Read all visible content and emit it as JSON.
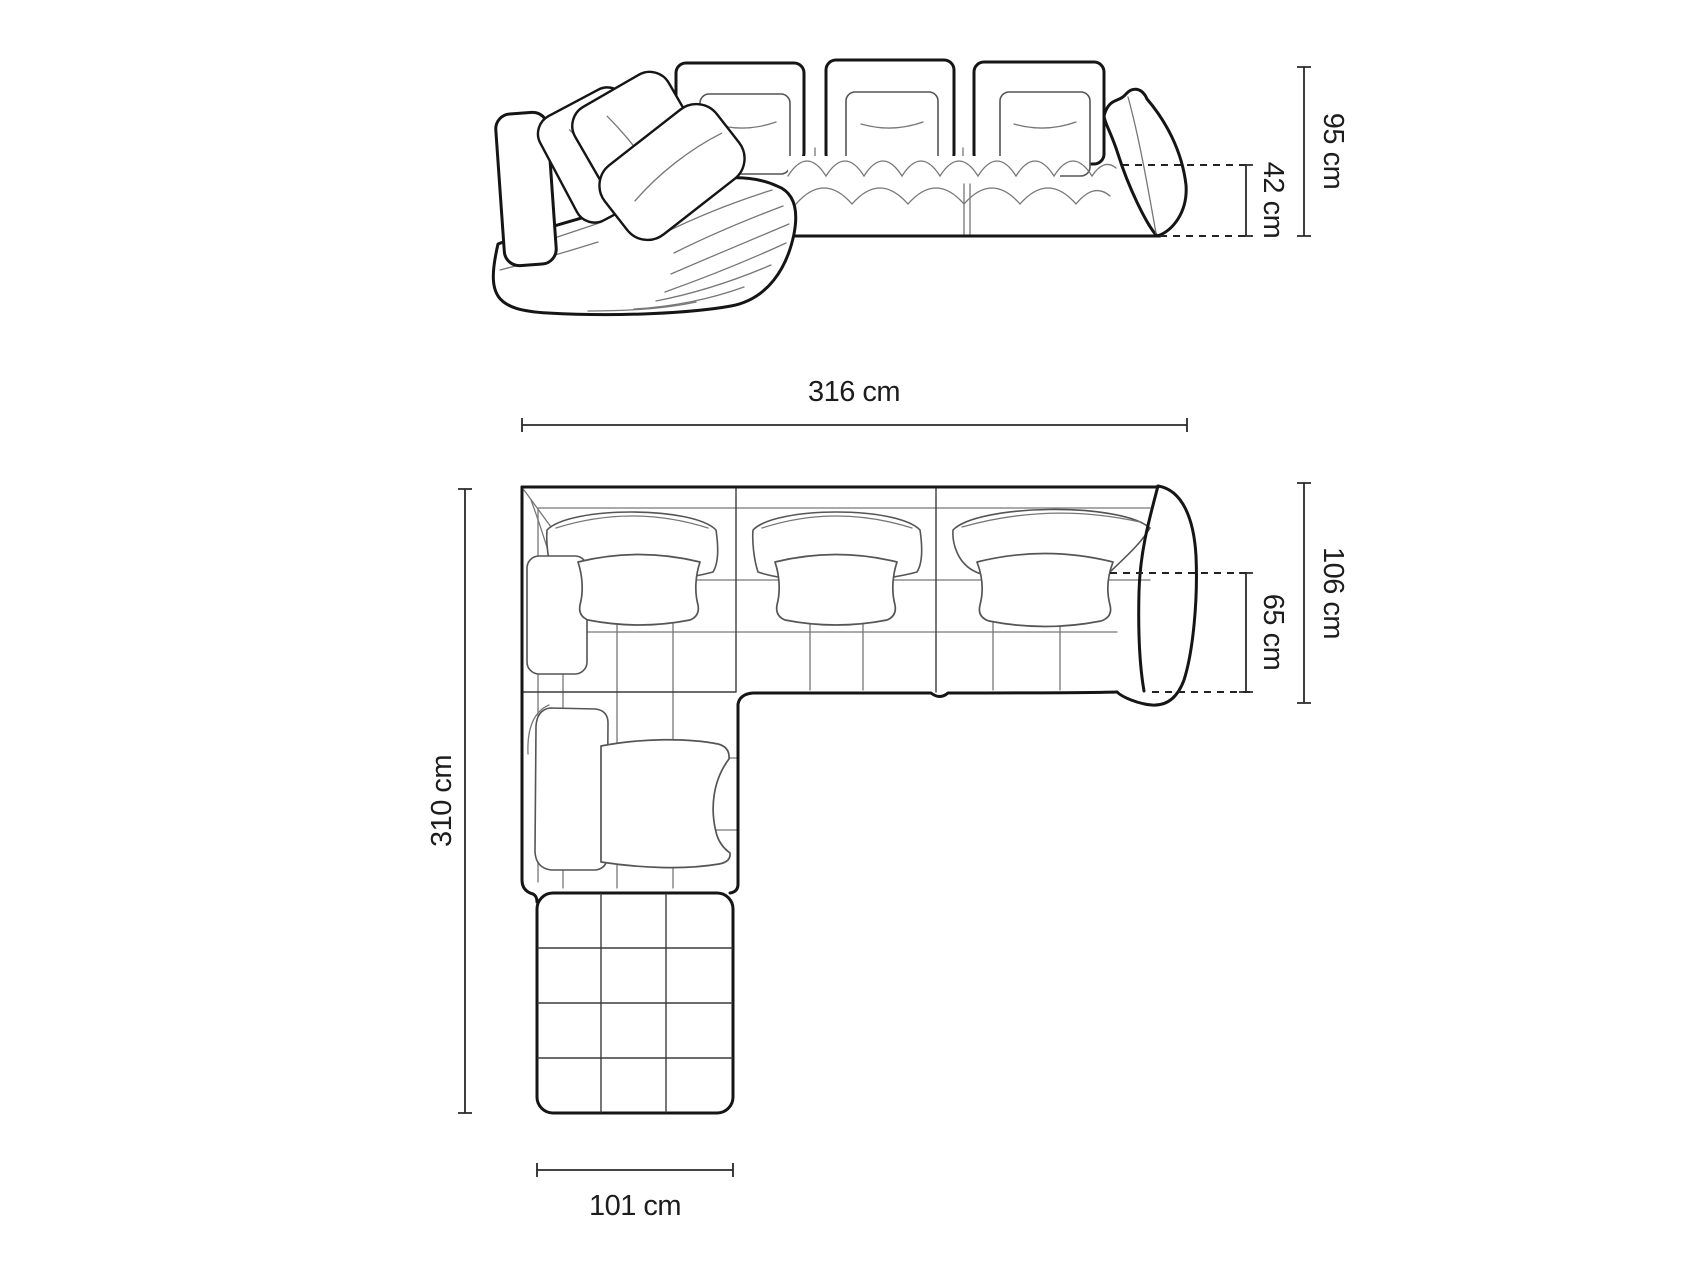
{
  "diagram": {
    "subject": "corner-sofa-technical-drawing",
    "unit": "cm",
    "views": {
      "front": {
        "name": "front-view",
        "dims": {
          "total_height": "95 cm",
          "seat_height": "42 cm"
        }
      },
      "top": {
        "name": "top-view",
        "dims": {
          "total_width": "316 cm",
          "total_depth": "310 cm",
          "body_depth": "106 cm",
          "seat_depth": "65 cm",
          "chaise_width": "101 cm"
        }
      }
    },
    "colors": {
      "background": "#ffffff",
      "outline": "#151515",
      "detail_line": "#777777",
      "dimension_line": "#2a2a2a",
      "label_text": "#1d1d1d"
    }
  }
}
